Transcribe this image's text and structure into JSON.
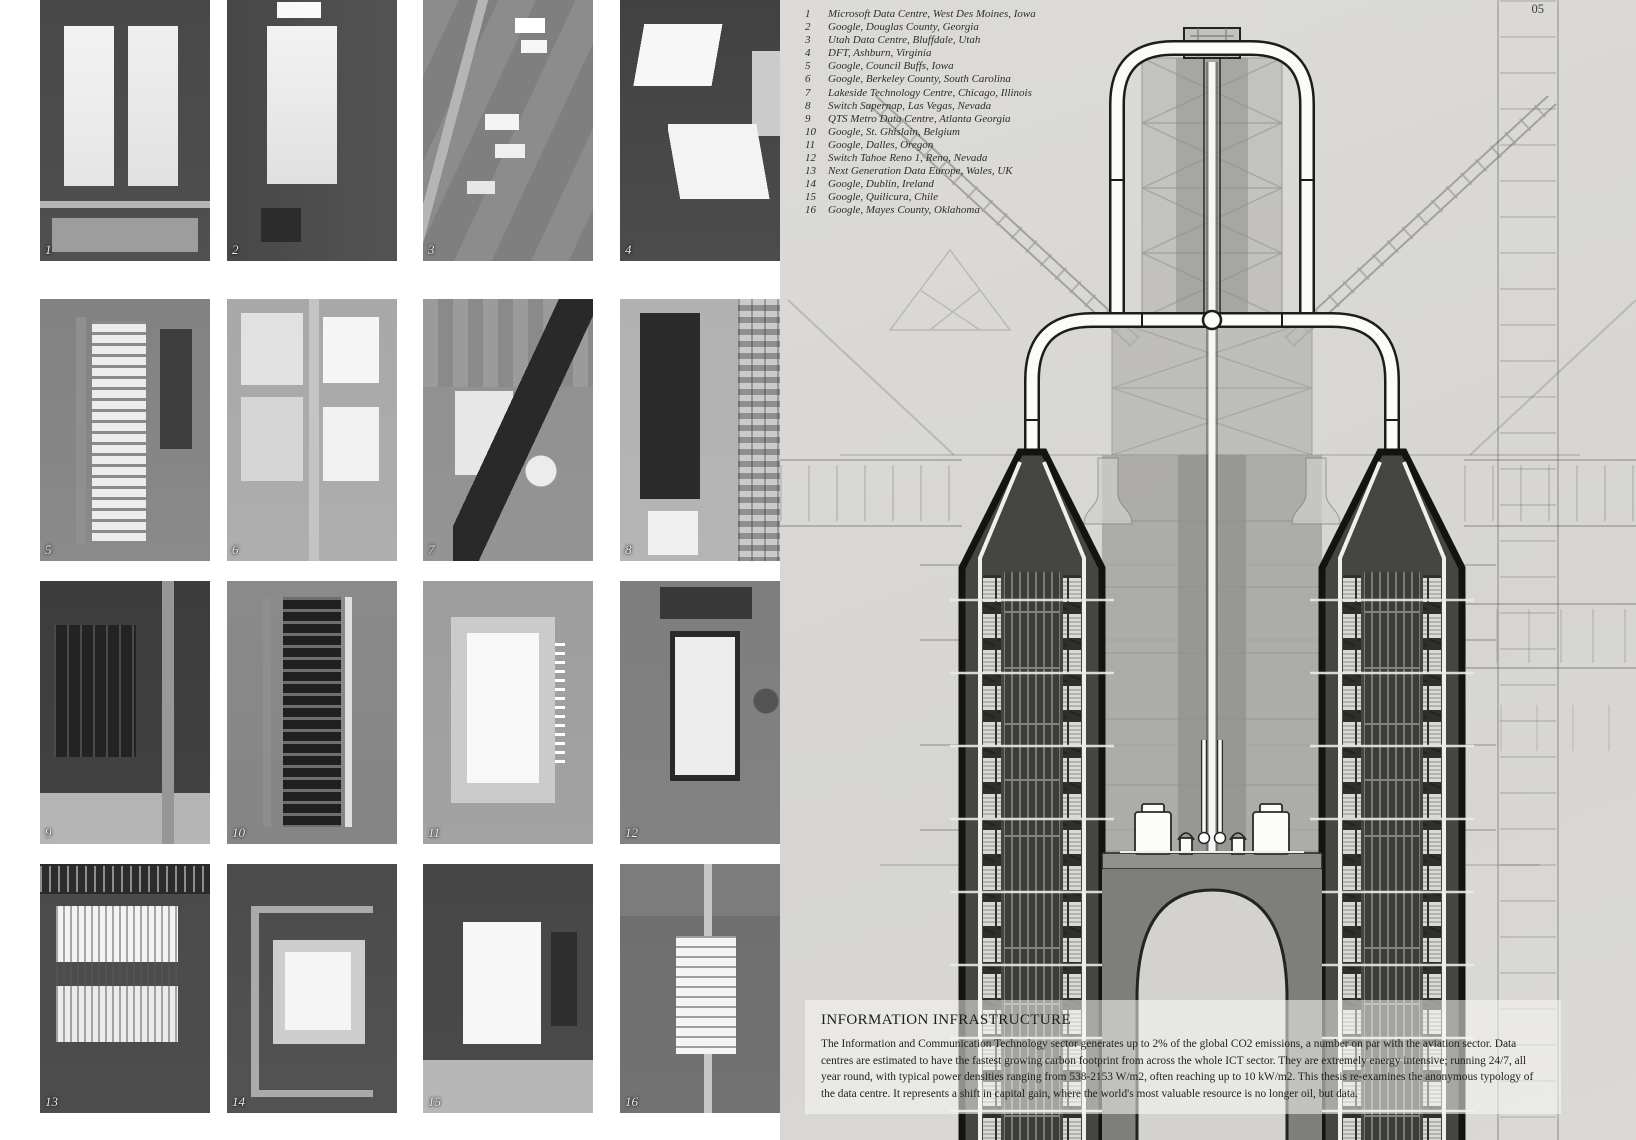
{
  "page": {
    "number": "05"
  },
  "legend": {
    "items": [
      {
        "num": "1",
        "label": "Microsoft Data Centre, West Des Moines, Iowa"
      },
      {
        "num": "2",
        "label": "Google, Douglas County, Georgia"
      },
      {
        "num": "3",
        "label": "Utah Data Centre, Bluffdale, Utah"
      },
      {
        "num": "4",
        "label": "DFT, Ashburn, Virginia"
      },
      {
        "num": "5",
        "label": "Google, Council Buffs, Iowa"
      },
      {
        "num": "6",
        "label": "Google, Berkeley County, South Carolina"
      },
      {
        "num": "7",
        "label": "Lakeside Technology Centre, Chicago, Illinois"
      },
      {
        "num": "8",
        "label": "Switch Supernap, Las Vegas, Nevada"
      },
      {
        "num": "9",
        "label": "QTS Metro Data Centre, Atlanta Georgia"
      },
      {
        "num": "10",
        "label": "Google, St. Ghislain, Belgium"
      },
      {
        "num": "11",
        "label": "Google, Dalles, Oregon"
      },
      {
        "num": "12",
        "label": "Switch Tahoe Reno 1, Reno, Nevada"
      },
      {
        "num": "13",
        "label": "Next Generation Data Europe, Wales, UK"
      },
      {
        "num": "14",
        "label": "Google, Dublin, Ireland"
      },
      {
        "num": "15",
        "label": "Google, Quilicura, Chile"
      },
      {
        "num": "16",
        "label": "Google, Mayes County, Oklahoma"
      }
    ]
  },
  "grid": {
    "tiles": [
      {
        "num": "1"
      },
      {
        "num": "2"
      },
      {
        "num": "3"
      },
      {
        "num": "4"
      },
      {
        "num": "5"
      },
      {
        "num": "6"
      },
      {
        "num": "7"
      },
      {
        "num": "8"
      },
      {
        "num": "9"
      },
      {
        "num": "10"
      },
      {
        "num": "11"
      },
      {
        "num": "12"
      },
      {
        "num": "13"
      },
      {
        "num": "14"
      },
      {
        "num": "15"
      },
      {
        "num": "16"
      }
    ]
  },
  "info": {
    "title": "INFORMATION INFRASTRUCTURE",
    "body": "The Information and Communication Technology sector generates up to 2% of the global CO2 emissions, a number on par with the aviation sector. Data centres are estimated to have the fastest growing carbon footprint from across the whole ICT sector. They are extremely energy intensive; running 24/7, all year round, with typical power densities ranging from 538-2153 W/m2, often reaching up to 10 kW/m2. This thesis re-examines the anonymous typology of the data centre. It represents a shift in capital gain, where the world's most valuable resource is no longer oil, but data."
  }
}
